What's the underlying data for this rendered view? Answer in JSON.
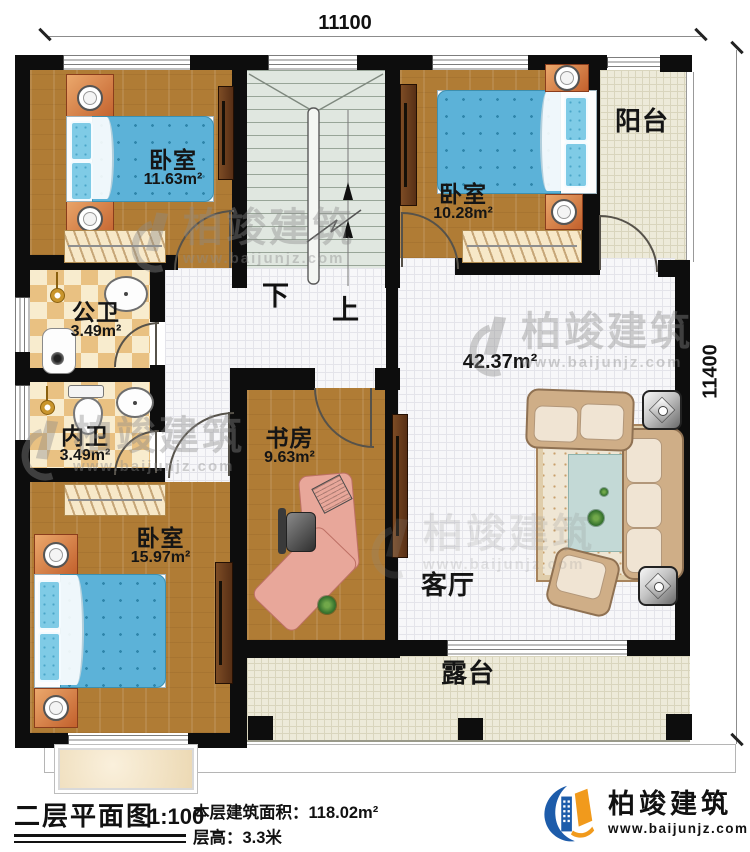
{
  "dimensions": {
    "top": "11100",
    "right": "11400"
  },
  "rooms": [
    {
      "name": "卧室",
      "area": "11.63m²"
    },
    {
      "name": "卧室",
      "area": "10.28m²"
    },
    {
      "name": "阳台",
      "area": ""
    },
    {
      "name": "公卫",
      "area": "3.49m²"
    },
    {
      "name": "内卫",
      "area": "3.49m²"
    },
    {
      "name": "卧室",
      "area": "15.97m²"
    },
    {
      "name": "书房",
      "area": "9.63m²"
    },
    {
      "name": "客厅",
      "area": "42.37m²"
    },
    {
      "name": "露台",
      "area": ""
    }
  ],
  "stairs": {
    "down": "下",
    "up": "上"
  },
  "footer": {
    "title": "二层平面图",
    "scale": "1:100",
    "area_label": "本层建筑面积：",
    "area_value": "118.02m²",
    "height_label": "层高：",
    "height_value": "3.3米"
  },
  "brand": {
    "name": "柏竣建筑",
    "url": "www.baijunjz.com"
  },
  "watermark": {
    "name": "柏竣建筑",
    "url": "www.baijunjz.com"
  },
  "colors": {
    "wall": "#0d0d0d",
    "wood_floor": "#b07c35",
    "white_tile": "#f7f7f9",
    "cream_tile": "#edead9",
    "bath_tile": "#e9c182",
    "stair_tile": "#e0e7e0",
    "bed_blue": "#5cb2d8",
    "logo_blue": "#1d5caa",
    "logo_orange": "#f19a1c"
  }
}
